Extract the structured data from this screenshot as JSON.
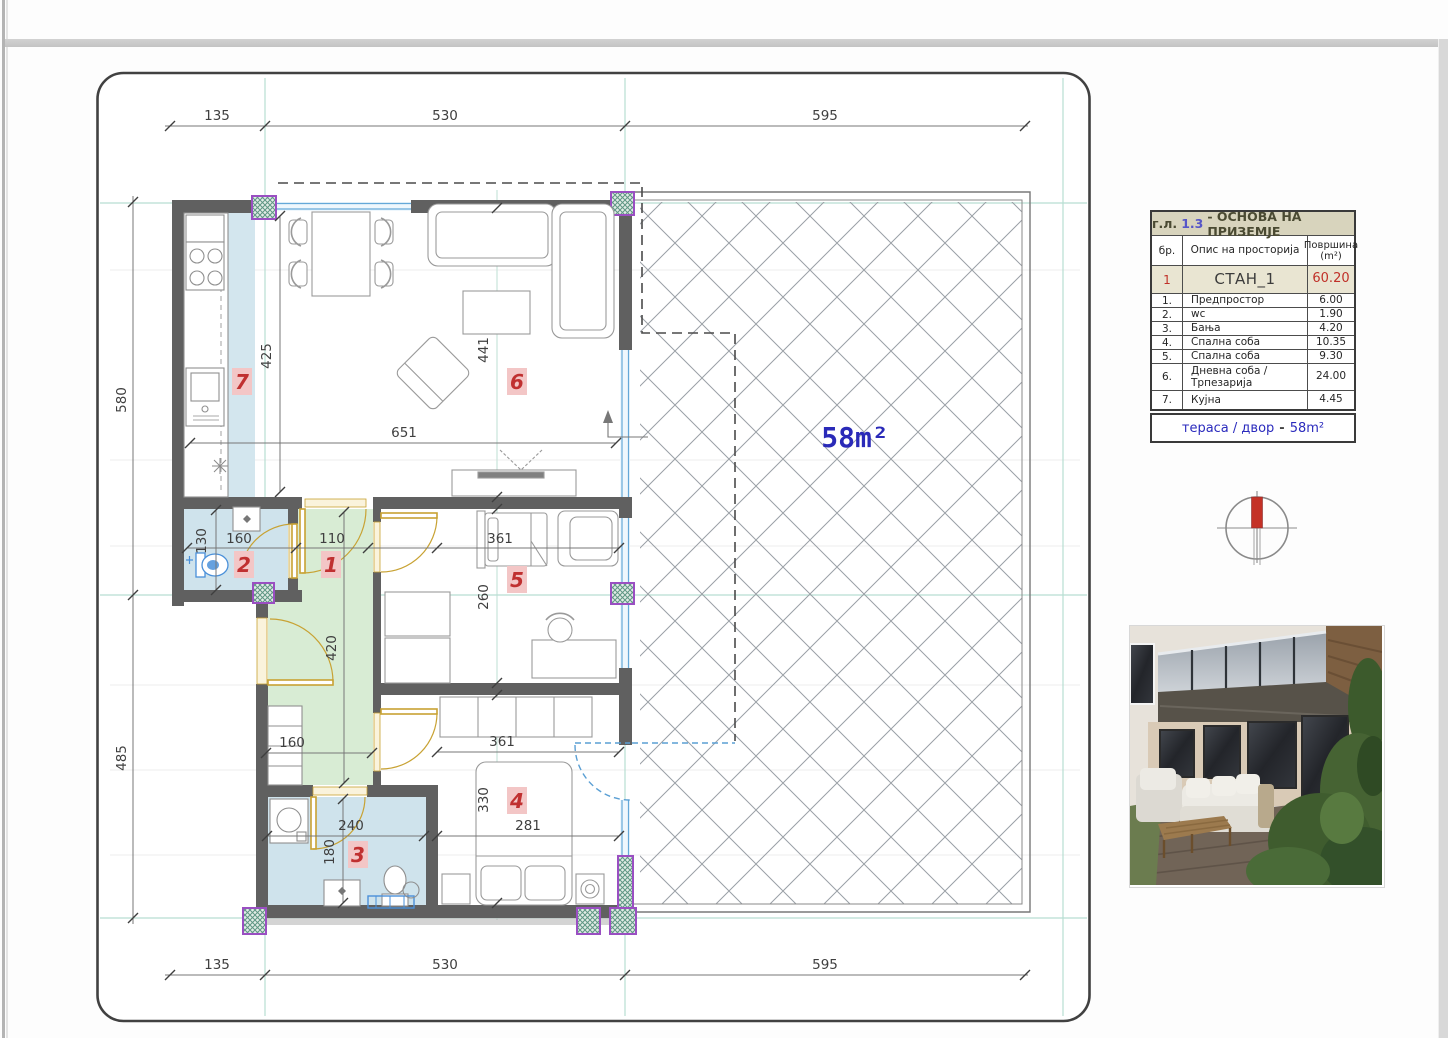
{
  "sheet": {
    "title_block": {
      "prefix": "г.л.",
      "sheet_no": "1.3",
      "title": "- ОСНОВА НА ПРИЗЕМЈЕ",
      "columns": {
        "no": "бр.",
        "desc": "Опис на просторија",
        "area_line1": "Површина",
        "area_line2": "(m²)"
      },
      "apartment": {
        "no": "1",
        "name": "СТАН_1",
        "area": "60.20"
      },
      "rooms": [
        {
          "no": "1.",
          "name": "Предпростор",
          "area": "6.00"
        },
        {
          "no": "2.",
          "name": "wc",
          "area": "1.90"
        },
        {
          "no": "3.",
          "name": "Бања",
          "area": "4.20"
        },
        {
          "no": "4.",
          "name": "Спална соба",
          "area": "10.35"
        },
        {
          "no": "5.",
          "name": "Спална соба",
          "area": "9.30"
        },
        {
          "no": "6.",
          "name": "Дневна соба /\nТрпезарија",
          "area": "24.00"
        },
        {
          "no": "7.",
          "name": "Кујна",
          "area": "4.45"
        }
      ]
    },
    "terrace_box": {
      "label": "тераса / двор",
      "sep": "-",
      "area": "58m²"
    }
  },
  "plan": {
    "terrace_area": "58m²",
    "room_numbers": {
      "hall": "1",
      "wc": "2",
      "bath": "3",
      "bed4": "4",
      "bed5": "5",
      "living": "6",
      "kitchen": "7"
    },
    "dims": {
      "top": [
        "135",
        "530",
        "595"
      ],
      "bottom": [
        "135",
        "530",
        "595"
      ],
      "left": [
        "580",
        "485"
      ],
      "kitchen_depth": "425",
      "living_width": "651",
      "living_height": "441",
      "wc_width": "160",
      "wc_height": "130",
      "hall_width": "110",
      "hall_height": "420",
      "hall_lower_width": "160",
      "bed5_width": "361",
      "bed5_height": "260",
      "bath_width": "240",
      "bath_height": "180",
      "bed4_top_width": "361",
      "bed4_width": "281",
      "bed4_height": "330"
    }
  },
  "colors": {
    "wall": "#606060",
    "window_blue": "#64a8d8",
    "floor_blue": "#cfe3ec",
    "floor_green": "#d8ecd4",
    "door_gold": "#c8a233",
    "column_purple": "#9a4fc2",
    "accent_red": "#c03028",
    "label_blue": "#2a2ab8",
    "axis_teal": "#b7ded2",
    "table_header_bg": "#d8d4bd"
  }
}
